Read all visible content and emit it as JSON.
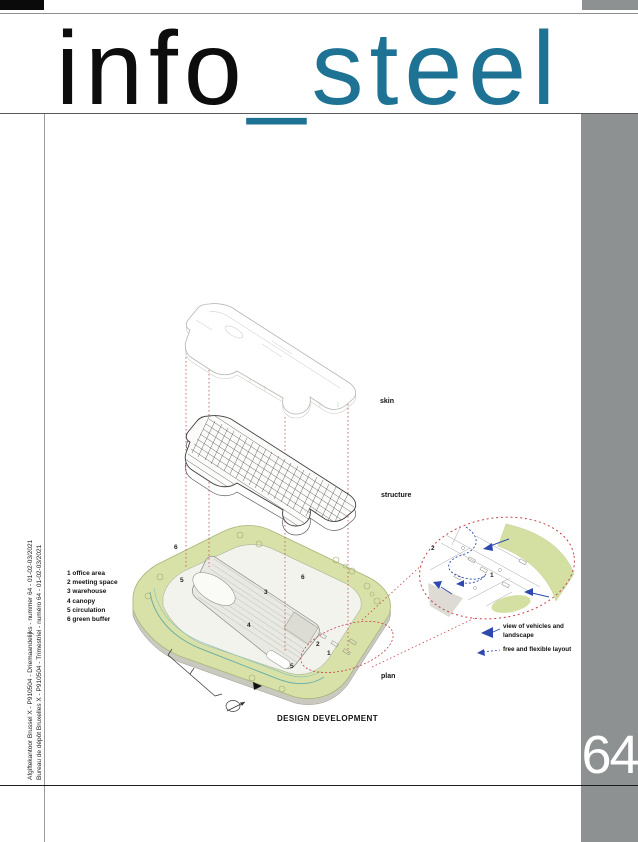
{
  "masthead": {
    "title_black": "info",
    "title_accent": "_steel"
  },
  "side_band": {
    "page_number": "64"
  },
  "spine": {
    "line1": "Afgiftekantoor Brussel X - P910504 - Driemaandelijks - nummer 64 - 01-02-03/2021",
    "line2": "Bureau de dépôt Bruxelles X - P910504 - Trimestriel - numéro 64 - 01-02-03/2021"
  },
  "figure": {
    "caption": "DESIGN DEVELOPMENT",
    "labels": {
      "skin": "skin",
      "structure": "structure",
      "plan": "plan"
    },
    "legend": [
      "1 office area",
      "2 meeting space",
      "3 warehouse",
      "4 canopy",
      "5 circulation",
      "6 green buffer"
    ],
    "plan_markers": [
      "6",
      "5",
      "3",
      "6",
      "4",
      "2",
      "1",
      "5"
    ],
    "inset_markers": [
      "2",
      "1"
    ],
    "inset_legend": {
      "item1_line1": "view of vehicles and",
      "item1_line2": "landscape",
      "item2": "free and flexible layout"
    }
  },
  "colors": {
    "accent_teal": "#1e7294",
    "band_gray": "#8e9192",
    "callout_red": "#c8414b",
    "site_green": "#d8e2a8",
    "arrow_blue": "#2d49ae"
  }
}
